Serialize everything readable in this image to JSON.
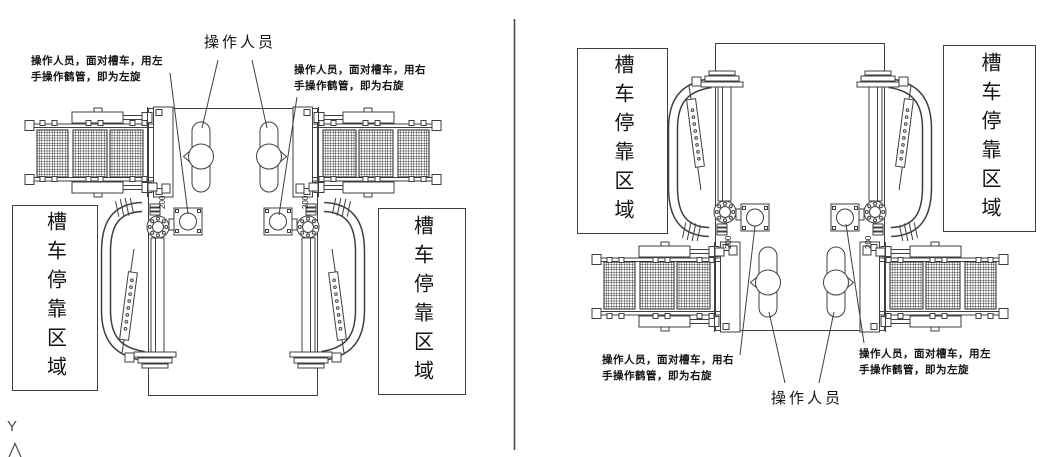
{
  "colors": {
    "line": "#3f3f3f",
    "hatch": "#262626",
    "text": "#141414",
    "divider": "#4a4a4a"
  },
  "left_view": {
    "operator_label": "操作人员",
    "note_left": {
      "line1": "操作人员，面对槽车，用左",
      "line2": "手操作鹤管，即为左旋"
    },
    "note_right": {
      "line1": "操作人员，面对槽车，用右",
      "line2": "手操作鹤管，即为右旋"
    },
    "zone_left": "槽车停靠区域",
    "zone_right": "槽车停靠区域",
    "dims": {
      "left": "200",
      "right": "200"
    }
  },
  "right_view": {
    "operator_label": "操作人员",
    "note_left": {
      "line1": "操作人员，面对槽车，用右",
      "line2": "手操作鹤管，即为右旋"
    },
    "note_right": {
      "line1": "操作人员，面对槽车，用左",
      "line2": "手操作鹤管，即为左旋"
    },
    "zone_left": "槽车停靠区域",
    "zone_right": "槽车停靠区域",
    "dims": {
      "left": "200",
      "right": "200"
    }
  },
  "axis": {
    "y_label": "Y"
  }
}
